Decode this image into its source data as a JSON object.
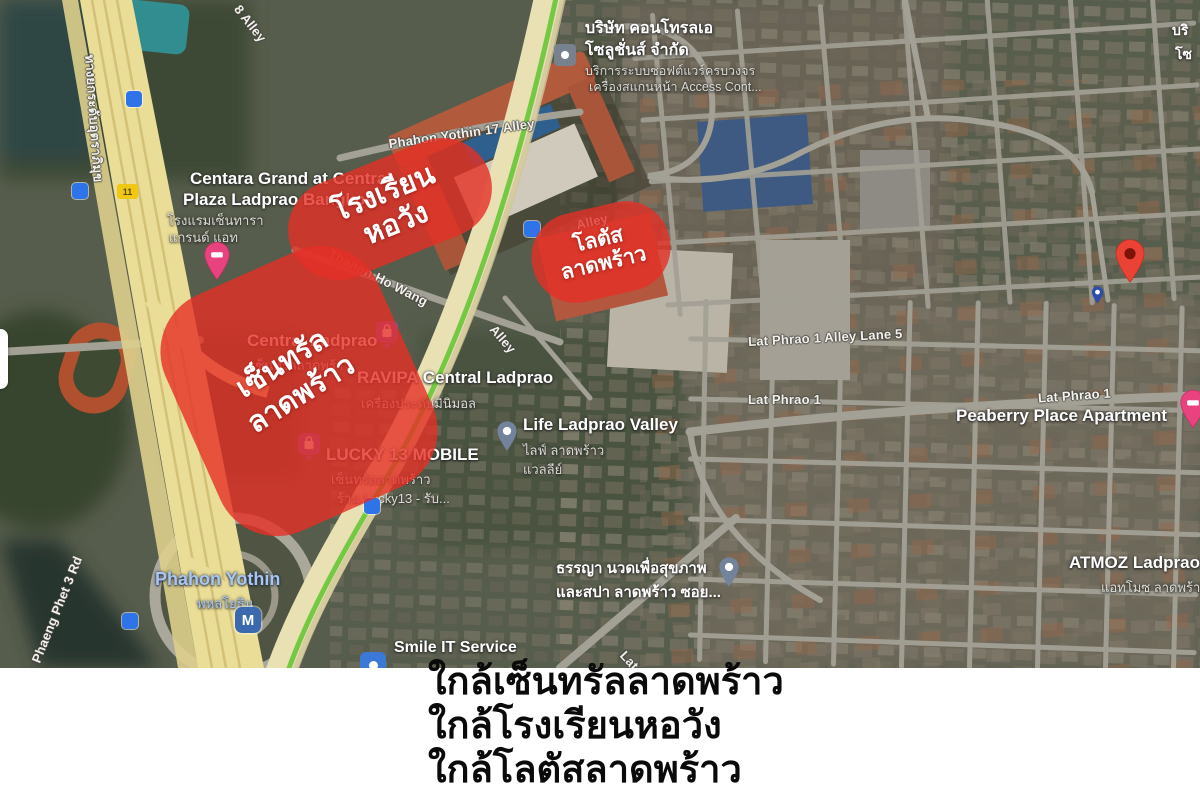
{
  "map": {
    "highlights": [
      {
        "id": "horwang-school",
        "lines": [
          "โรงเรียน",
          "หอวัง"
        ]
      },
      {
        "id": "lotus-ladprao",
        "lines": [
          "โลตัส",
          "ลาดพร้าว"
        ]
      },
      {
        "id": "central-ladprao",
        "lines": [
          "เซ็นทรัล",
          "ลาดพร้าว"
        ]
      }
    ],
    "roads": [
      {
        "text": "8 Alley"
      },
      {
        "text": "Phahon Yothin 17 Alley"
      },
      {
        "text": "Thanon Ho Wang"
      },
      {
        "text": "Alley"
      },
      {
        "text": "Alley"
      },
      {
        "text": "Lat Phrao 1 Alley Lane 5"
      },
      {
        "text": "Lat Phrao 1"
      },
      {
        "text": "Lat Phrao 1"
      },
      {
        "text": "Lat Phrao 1"
      },
      {
        "text": "Phaeng Phet 3 Rd"
      },
      {
        "text": "ทางยกระดับอุตราภิมุข"
      }
    ],
    "pois": [
      {
        "name_lines": [
          "Centara Grand at Central",
          "Plaza Ladprao Bangkok"
        ],
        "sub_lines": [
          "โรงแรมเซ็นทารา",
          "แกรนด์ แอท"
        ],
        "icon": "hotel-pin"
      },
      {
        "name_lines": [
          "บริษัท คอนโทรลเอ",
          "โซลูชั่นส์ จำกัด"
        ],
        "sub_lines": [
          "บริการระบบซอฟต์แวร์ครบวงจร",
          "เครื่องสแกนหน้า Access Cont..."
        ],
        "icon": "generic-poi"
      },
      {
        "name_lines": [
          "Central Ladprao"
        ],
        "sub_lines": [
          "เซ็นทรัลลาดพร้าว"
        ],
        "icon": "shopping-pin"
      },
      {
        "name_lines": [
          "RAVIPA Central Ladprao"
        ],
        "sub_lines": [
          "เครื่องประดับมินิมอล"
        ],
        "icon": "none"
      },
      {
        "name_lines": [
          "LUCKY 13 MOBILE"
        ],
        "sub_lines": [
          "เซ็นทรัลลาดพร้าว",
          "ร้าน Lucky13 - รับ..."
        ],
        "icon": "shopping-pin"
      },
      {
        "name_lines": [
          "Life Ladprao Valley"
        ],
        "sub_lines": [
          "ไลฟ์ ลาดพร้าว",
          "แวลลีย์"
        ],
        "icon": "gray-pin"
      },
      {
        "name_lines": [
          "Peaberry Place Apartment"
        ],
        "sub_lines": [],
        "icon": "hotel-pin"
      },
      {
        "name_lines": [
          "ATMOZ Ladprao"
        ],
        "sub_lines": [
          "แอทโมซ ลาดพร้าว"
        ],
        "icon": "none"
      },
      {
        "name_lines": [
          "ธรรญา นวดเพื่อสุขภาพ",
          "และสปา ลาดพร้าว ซอย..."
        ],
        "sub_lines": [],
        "icon": "gray-pin"
      },
      {
        "name_lines": [
          "Smile IT Service"
        ],
        "sub_lines": [],
        "icon": "blue-square"
      },
      {
        "name_lines": [
          "บริ",
          "โซ"
        ],
        "sub_lines": [],
        "icon": "none"
      }
    ],
    "station": {
      "name": "Phahon Yothin",
      "thai": "พหลโยธิน",
      "symbol": "M"
    },
    "route_shield": "11",
    "colors": {
      "highlight_red": "#e53025",
      "destination_pin": "#ea4335",
      "transit_blue": "#2e74e8",
      "station_text": "#a9c6f2",
      "bts_line_green": "#74c944"
    }
  },
  "caption": {
    "lines": [
      "ใกล้เซ็นทรัลลาดพร้าว",
      "ใกล้โรงเรียนหอวัง",
      "ใกล้โลตัสลาดพร้าว"
    ]
  }
}
